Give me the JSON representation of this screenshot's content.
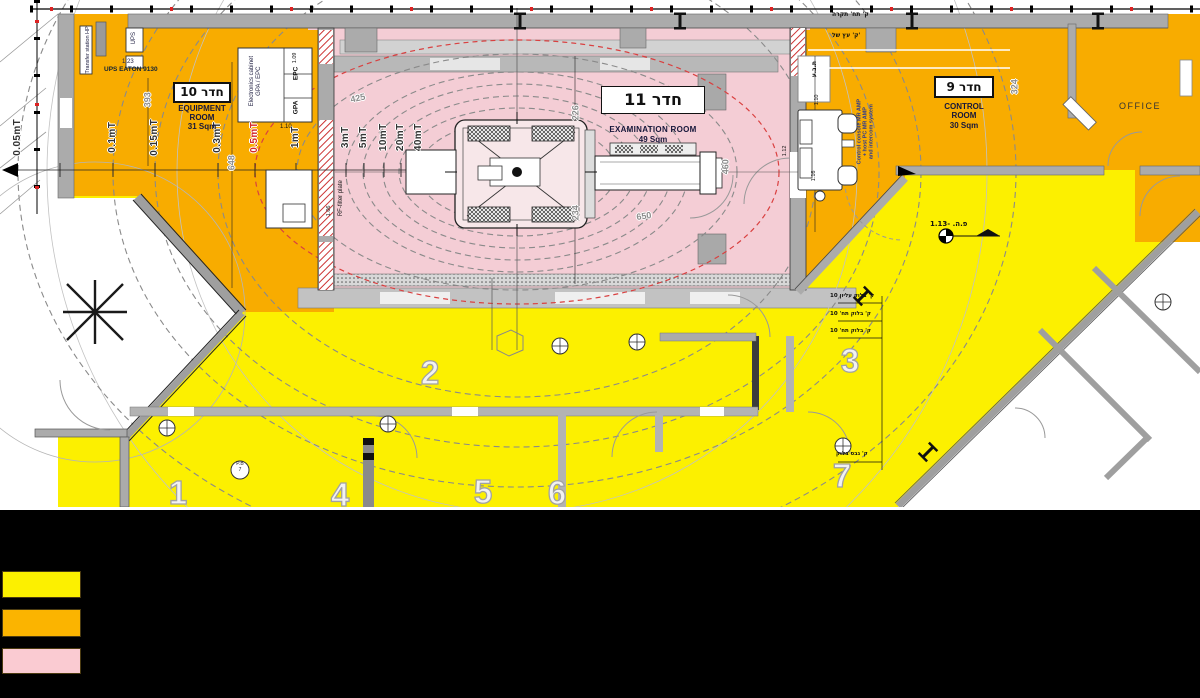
{
  "plan": {
    "rooms": {
      "equipment": {
        "tag": "10 חדר",
        "line1": "EQUIPMENT",
        "line2": "ROOM",
        "area": "31 Sqm"
      },
      "examination": {
        "tag": "11 חדר",
        "name": "EXAMINATION ROOM",
        "area": "49 Sqm"
      },
      "control": {
        "tag": "9 חדר",
        "line1": "CONTROL",
        "line2": "ROOM",
        "area": "30 Sqm"
      },
      "office": {
        "name": "OFFICE"
      }
    },
    "contour_labels": [
      {
        "label": "0.05mT",
        "color": "#333333"
      },
      {
        "label": "0.1mT",
        "color": "#333333"
      },
      {
        "label": "0.15mT",
        "color": "#333333"
      },
      {
        "label": "0.3mT",
        "color": "#333333"
      },
      {
        "label": "0.5mT",
        "color": "#d42a2a"
      },
      {
        "label": "1mT",
        "color": "#333333"
      },
      {
        "label": "3mT",
        "color": "#333333"
      },
      {
        "label": "5mT",
        "color": "#333333"
      },
      {
        "label": "10mT",
        "color": "#333333"
      },
      {
        "label": "20mT",
        "color": "#333333"
      },
      {
        "label": "40mT",
        "color": "#333333"
      }
    ],
    "zone_numbers": [
      "1",
      "2",
      "3",
      "4",
      "5",
      "6",
      "7"
    ],
    "dimensions": [
      "393",
      "648",
      "425",
      "226",
      "234",
      "650",
      "460",
      "324"
    ],
    "equipment_labels": {
      "transfer_station": "Transfer station HP",
      "ups_box": "UPS",
      "tag_123": "1.23",
      "ups_name": "UPS EATON 9130",
      "cabinet_line1": "Electronics cabinet",
      "cabinet_line2": "GPA / EPC",
      "tag_109": "1.09",
      "epc": "EPC",
      "gpa": "GPA",
      "tag_110": "1.10",
      "tag_106": "1.06",
      "rf_filter": "RF-filter plate",
      "console_line1": "Control console MR AMP",
      "console_line2": "+ host PC MR AMP",
      "console_line3": "and intercom system",
      "tag_112": "1.12",
      "tag_110b": "1.10",
      "tag_116": "1.16"
    },
    "door_tag": {
      "line1": "P.B",
      "line2": "7"
    },
    "hebrew_notes": [
      "ק' תח' תקרה",
      "ק' עץ של'",
      "ת.ב.ע",
      "ק' בלוק עליון 10",
      "ק' בלוק תח' 10",
      "ק' בלוק תח' 10",
      "ק' גבס בלוק"
    ],
    "level_marker": "פ.ה. -1.13"
  },
  "colors": {
    "yellow": "#FCF000",
    "orange": "#F8AC00",
    "pink": "#F4CDD5"
  },
  "legend": {
    "swatches": [
      {
        "id": "yellow",
        "color": "#FCF000"
      },
      {
        "id": "orange",
        "color": "#FBB400"
      },
      {
        "id": "pink",
        "color": "#FACBD2"
      }
    ]
  }
}
